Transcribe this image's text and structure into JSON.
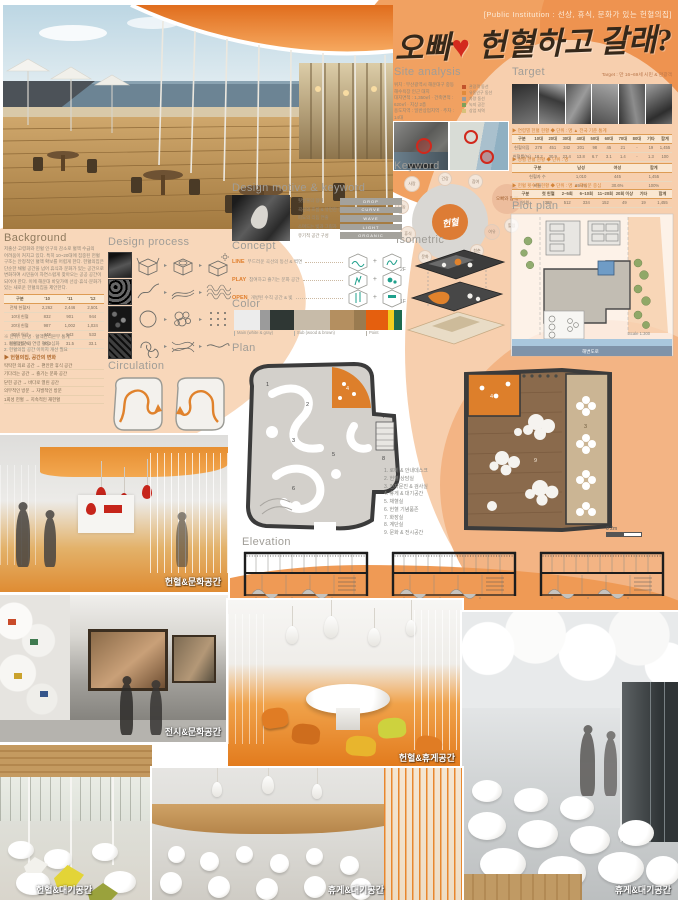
{
  "poster": {
    "subtitle": "[Public Institution : 선상, 휴식, 문화가 있는 헌혈의집]",
    "title_pre": "오빠",
    "title_heart": "♥",
    "title_post": " 헌혈하고 갈래?"
  },
  "headings": {
    "site_analysis": "Site analysis",
    "target": "Target",
    "keyword": "Keyword",
    "isometric": "Isometric",
    "plot_plan": "Plot plan",
    "design_motive": "Design motive & keyword",
    "background": "Background",
    "design_process": "Design process",
    "concept": "Concept",
    "color": "Color",
    "plan": "Plan",
    "circulation": "Circulation",
    "elevation": "Elevation"
  },
  "misc": {
    "arrow": "▸",
    "scale_plan": "0     2m",
    "scale_elev": "0     2m"
  },
  "site_analysis": {
    "lines": [
      "위치 : 부산광역시 해운대구 중동 해수욕장 인근 대지",
      "대지면적 : 1,350㎡ · 건축면적 : 620㎡ · 지상 2층",
      "용도지역 : 일반상업지역 · 주차 : 14대",
      "▶ 접근성 분석",
      "해운대 해수욕장 + 달맞이길 + 구남로 상권 · 대중교통 + 유동인구"
    ],
    "legend": [
      "관광객 동선",
      "유동인구 동선",
      "차량 동선",
      "녹지 공간",
      "상업 지역"
    ]
  },
  "target": {
    "note": "Target : 만 16~69세 시민 & 관광객",
    "table1_title": "▶ 연령별 헌혈 현황  ◆ 단위 : 명  ▲ 전국 기준 통계",
    "table1": {
      "header": [
        "구분",
        "10대",
        "20대",
        "30대",
        "40대",
        "50대",
        "60대",
        "70대",
        "80대",
        "기타",
        "합계"
      ],
      "rows": [
        [
          "헌혈의집",
          "278",
          "451",
          "342",
          "201",
          "98",
          "45",
          "21",
          "-",
          "19",
          "1,455"
        ],
        [
          "헌혈률(%)",
          "18.2",
          "30.9",
          "23.4",
          "13.8",
          "6.7",
          "3.1",
          "1.4",
          "-",
          "1.3",
          "100"
        ]
      ]
    },
    "table2_title": "▶ 성별 헌혈 현황  ◆ 단위 : 명",
    "table2": {
      "header": [
        "구분",
        "남성",
        "여성",
        "합계"
      ],
      "rows": [
        [
          "헌혈자 수",
          "1,010",
          "445",
          "1,455"
        ],
        [
          "비율",
          "69.4%",
          "30.6%",
          "100%"
        ]
      ]
    },
    "table3_title": "▶ 헌혈 횟수별 현황  ◆ 단위 : 명  ▲ 재방문 중심",
    "table3": {
      "header": [
        "구분",
        "첫 헌혈",
        "2~5회",
        "6~10회",
        "11~20회",
        "20회 이상",
        "기타",
        "합계"
      ],
      "rows": [
        [
          "인원",
          "389",
          "512",
          "334",
          "152",
          "49",
          "19",
          "1,455"
        ]
      ]
    }
  },
  "keyword": {
    "center": "헌혈",
    "side": "오빠와 함께",
    "bubbles": [
      "사랑",
      "나눔",
      "휴식",
      "문화",
      "바다",
      "청춘",
      "여유",
      "참여",
      "건강",
      "힐링"
    ]
  },
  "plot_plan": {
    "road_label": "해변도로",
    "scale": "Scale 1:300"
  },
  "design_motive": {
    "rows": [
      {
        "desc": "핏방울의 형태",
        "tag": "DROP"
      },
      {
        "desc": "곡선의 흐름 & 유연한 동선",
        "tag": "CURVE"
      },
      {
        "desc": "파도의 리듬 연출",
        "tag": "WAVE"
      },
      {
        "desc": "스며드는 빛과 그림자",
        "tag": "LIGHT"
      },
      {
        "desc": "유기적 공간 구성",
        "tag": "ORGANIC"
      }
    ]
  },
  "concept": {
    "rows": [
      {
        "kw": "LINE",
        "desc": "부드러운 곡선의 동선 & 벽면"
      },
      {
        "kw": "PLAY",
        "desc": "참여하고 즐기는 문화 공간"
      },
      {
        "kw": "OPEN",
        "desc": "개방된 수직 공간 & 빛"
      }
    ],
    "plus": "+"
  },
  "color": {
    "swatch_hex": [
      "#ececec",
      "#9b9b9b",
      "#2f3734",
      "#c7bba9",
      "#b48f60",
      "#9a7b50",
      "#e55f0e",
      "#f2cf1f",
      "#1e6a4e"
    ],
    "labels": [
      "Main (white & gray)",
      "Sub (wood & brown)",
      "Point"
    ]
  },
  "plan": {
    "legend": [
      "1. 로비 & 안내데스크",
      "2. 헌혈 상담실",
      "3. 전자문진 & 검사실",
      "4. 휴게 & 대기공간",
      "5. 채혈실",
      "6. 헌혈 기념품존",
      "7. 화장실",
      "8. 계단실",
      "9. 문화 & 전시공간"
    ]
  },
  "circulation": {
    "labels": [
      "1F",
      "2F"
    ]
  },
  "background": {
    "para": [
      "저출산·고령화와 헌혈 인구의 감소로 혈액 수급의",
      "어려움이 커지고 있다. 특히 10~20대에 집중된 헌혈",
      "구조는 안정적인 혈액 확보를 어렵게 한다. 헌혈의집은",
      "단순한 채혈 공간을 넘어 휴식과 문화가 있는 공간으로",
      "변화하여 시민들이 자연스럽게 찾아오는 공공 공간이",
      "되어야 한다. 이에 해운대 바닷가에 선상·휴식·문화가",
      "있는 새로운 헌혈의집을 제안한다."
    ],
    "table": {
      "header": [
        "구분",
        "'10",
        "'11",
        "'12"
      ],
      "rows": [
        [
          "전체 헌혈자",
          "2,262",
          "2,446",
          "2,501"
        ],
        [
          "10대 헌혈",
          "832",
          "901",
          "944"
        ],
        [
          "20대 헌혈",
          "987",
          "1,002",
          "1,024"
        ],
        [
          "30대 이상",
          "443",
          "543",
          "533"
        ],
        [
          "재헌혈률(%)",
          "30.2",
          "31.5",
          "33.1"
        ]
      ]
    },
    "notes": [
      "※ 단위 : 천 명 · 혈액관리본부 통계",
      "1. 헌혈 인구의 연령 편중 심화",
      "2. 헌혈의집 공간 이미지 개선 필요"
    ],
    "pairs_title": "▶ 헌혈의집, 공간의 변화",
    "pairs": [
      [
        "딱딱한 의료 공간",
        "편안한 휴식 공간"
      ],
      [
        "기다리는 공간",
        "즐기는 문화 공간"
      ],
      [
        "닫힌 공간",
        "바다로 열린 공간"
      ],
      [
        "의무적인 방문",
        "자발적인 방문"
      ],
      [
        "1회성 헌혈",
        "지속적인 재헌혈"
      ]
    ]
  },
  "renders": {
    "r1_caption": "헌혈&문화공간",
    "r2_caption": "전시&문화공간",
    "r3_caption": "헌혈&휴게공간",
    "r4_caption": "휴게&대기공간",
    "r5_caption": "헌혈&대기공간",
    "r6_caption": "휴게&대기공간"
  }
}
